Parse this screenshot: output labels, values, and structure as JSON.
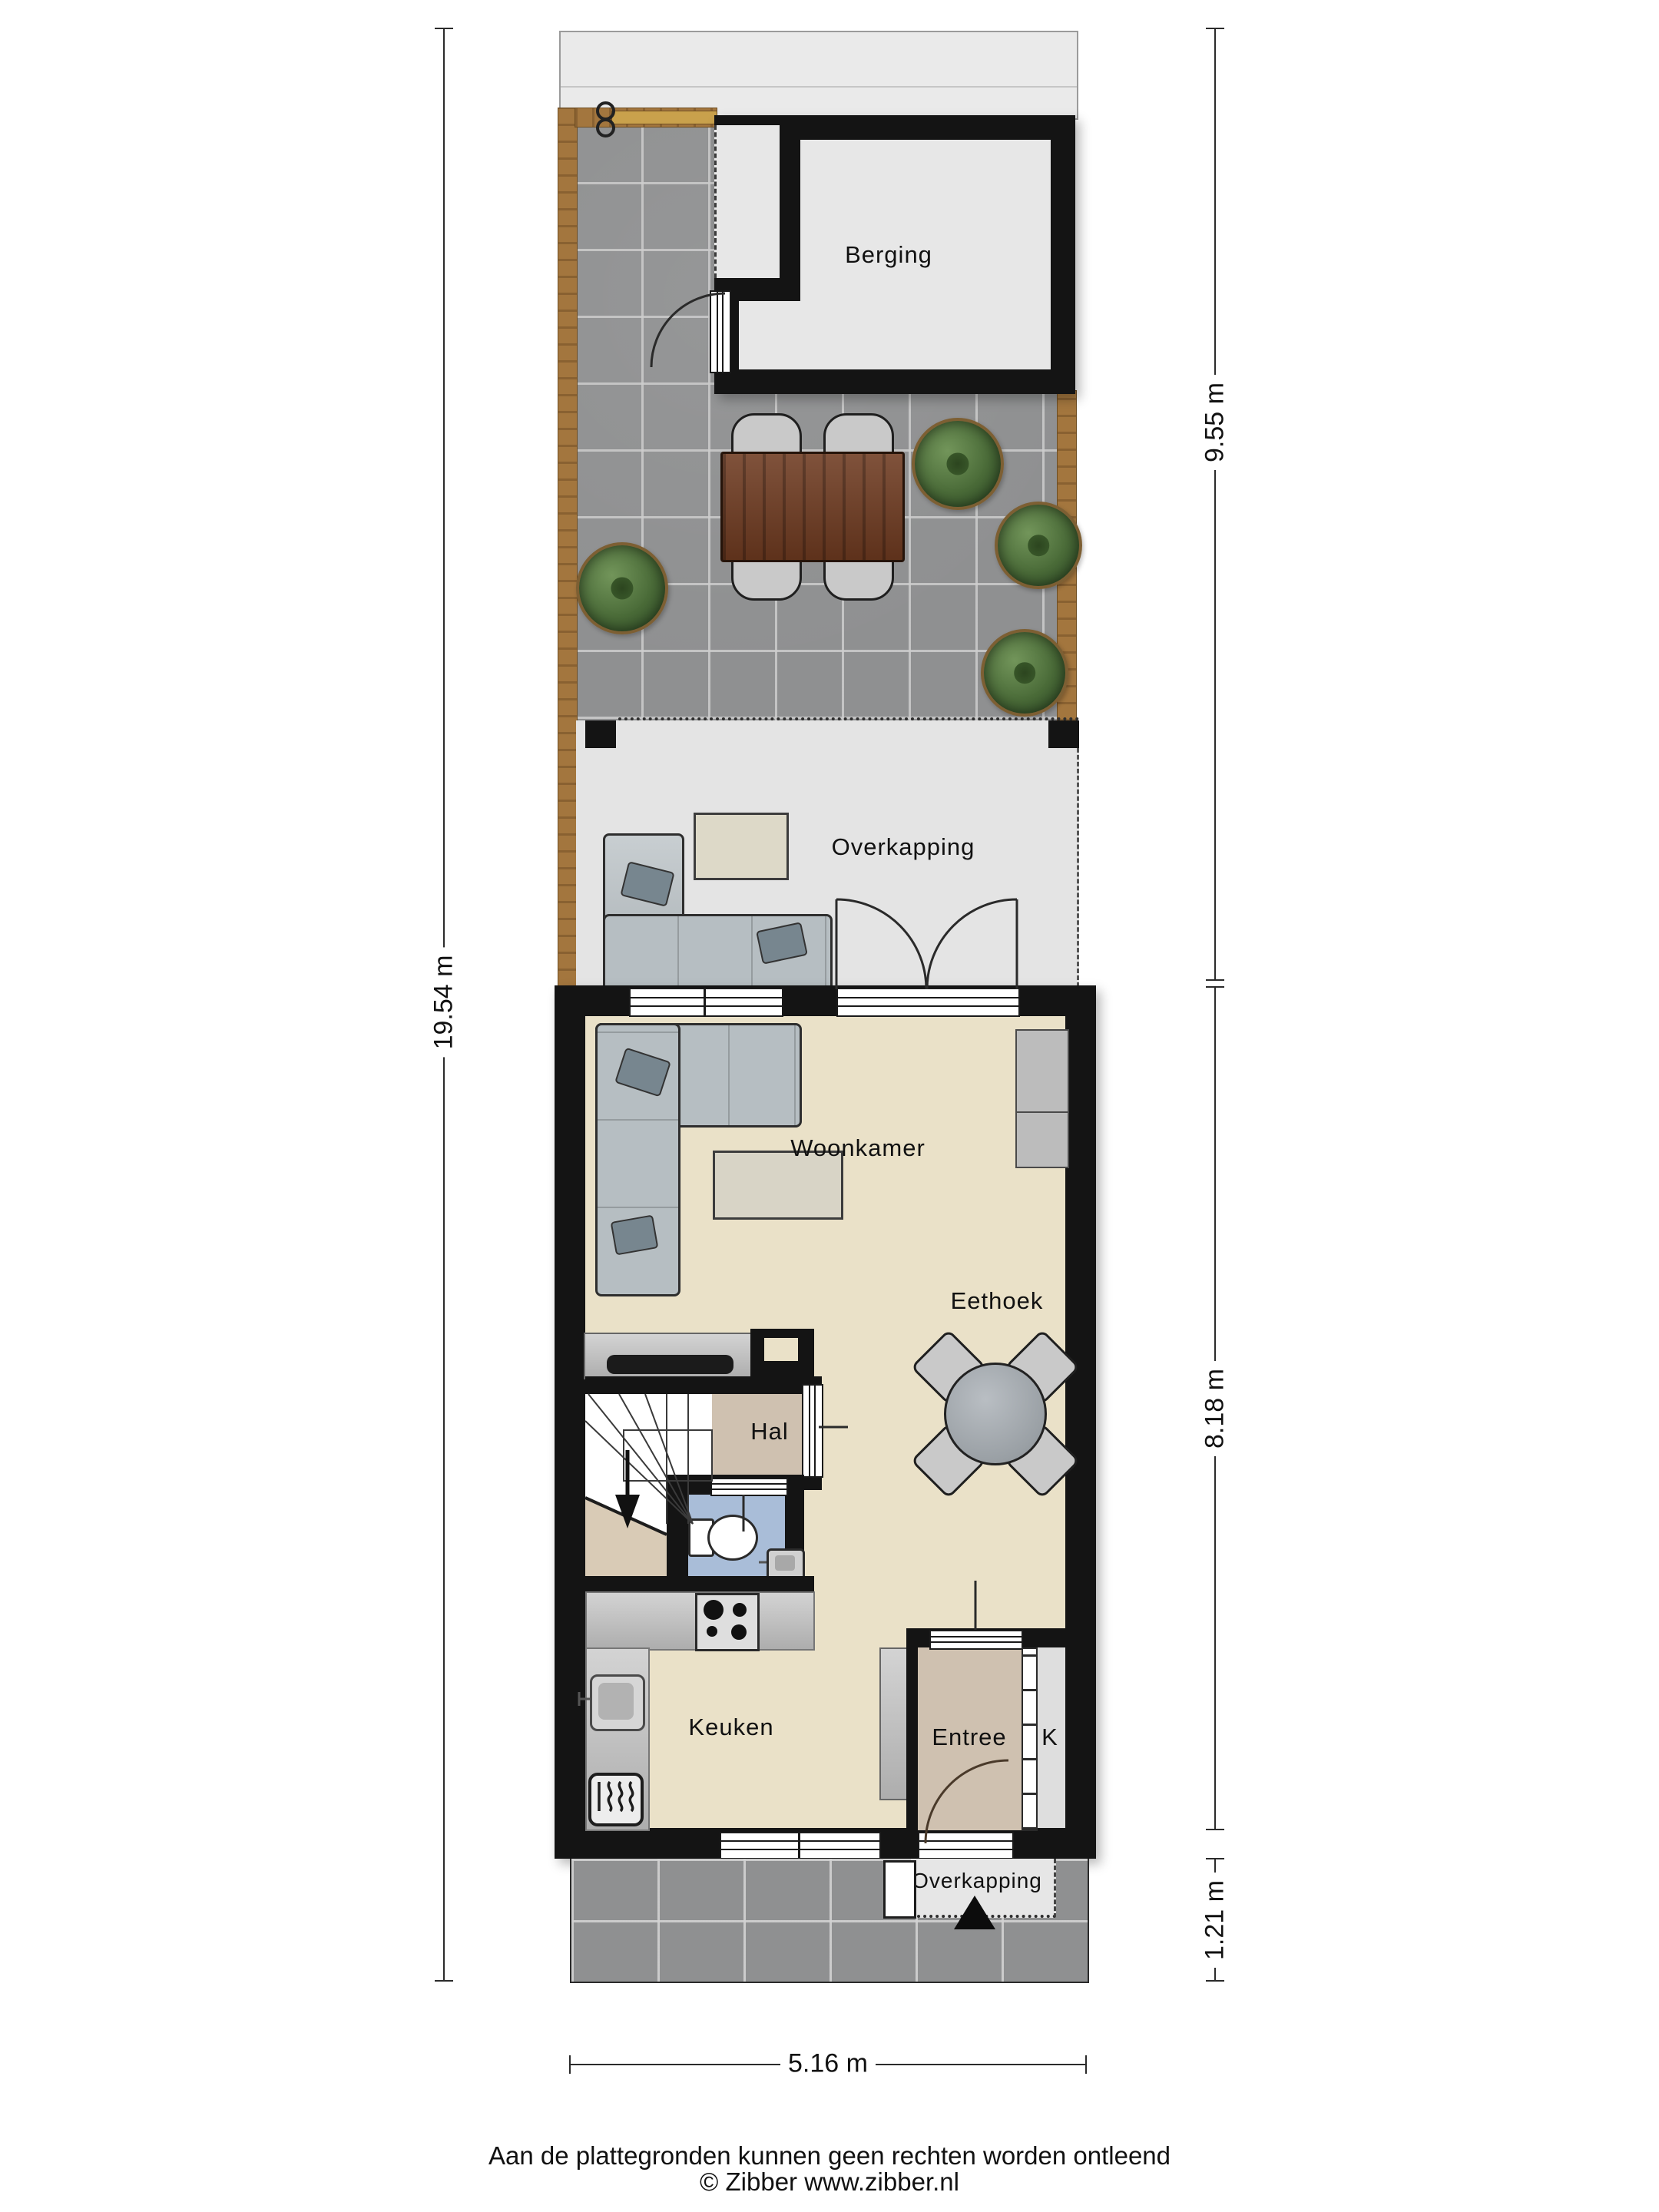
{
  "plan": {
    "type": "floorplan",
    "rooms": {
      "berging": "Berging",
      "overkapping_tuin": "Overkapping",
      "woonkamer": "Woonkamer",
      "eethoek": "Eethoek",
      "hal": "Hal",
      "keuken": "Keuken",
      "entree": "Entree",
      "kast": "K",
      "overkapping_voor": "Overkapping"
    },
    "dimensions": {
      "total_depth": "19.54 m",
      "garden_depth": "9.55 m",
      "house_depth": "8.18 m",
      "front_porch_depth": "1.21 m",
      "width": "5.16 m"
    },
    "colors": {
      "wall": "#141414",
      "floor_beige": "#eae1c8",
      "floor_tan": "#cfc1b0",
      "floor_blue": "#a9bdd8",
      "floor_light": "#e7e7e7",
      "patio_tile": "#8f9091",
      "fence_wood": "#a3763e",
      "gate_wood": "#c9a14c",
      "table_wood": "#6e3a20",
      "sofa": "#b6bec2",
      "plant_green": "#4a6b38",
      "counter_grey": "#bababa"
    },
    "icons": {
      "entrance_marker": "filled triangle",
      "stairs_direction": "arrow-down",
      "gate_hinge": "double ring",
      "heater": "wavy lines in rounded square"
    }
  },
  "footer": {
    "disclaimer": "Aan de plattegronden kunnen geen rechten worden ontleend",
    "copyright": "© Zibber www.zibber.nl"
  }
}
